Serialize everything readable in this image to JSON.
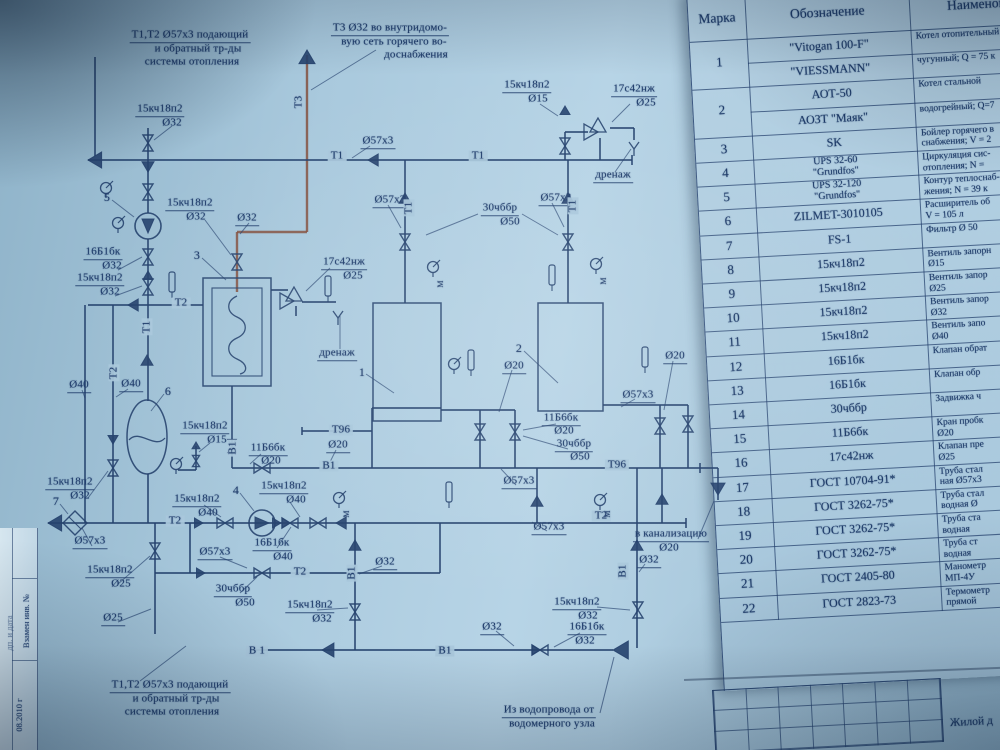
{
  "photo_meta": {
    "paper_color": "#a9c9dd",
    "line_color": "#27477a",
    "hot_pipe_color": "#84503e"
  },
  "frame": {
    "stamp_labels": [
      "Взамен инв. №",
      "08.2010 г",
      "дп. и дата"
    ]
  },
  "title_block": {
    "project_label": "Жилой д"
  },
  "diagram": {
    "labels": [
      "Т1,Т2 Ø57х3 подающий",
      "и обратный тр-ды",
      "системы отопления",
      "Т3 Ø32 во внутридомо-",
      "вую сеть горячего во-",
      "доснабжения",
      "15кч18п2",
      "Ø15",
      "17с42нж",
      "Ø25",
      "дренаж",
      "Т1",
      "Т1",
      "Ø57х3",
      "Т3",
      "15кч18п2",
      "Ø32",
      "5",
      "16Б1бк",
      "Ø32",
      "15кч18п2",
      "Ø32",
      "3",
      "15кч18п2",
      "Ø32",
      "Ø32",
      "17с42нж",
      "Ø25",
      "дренаж",
      "Т2",
      "Т1",
      "Т2",
      "Ø40",
      "Ø40",
      "6",
      "15кч18п2",
      "Ø15",
      "11Б6бк",
      "Ø20",
      "В1",
      "Т96",
      "Ø20",
      "В1",
      "15кч18п2",
      "Ø32",
      "7",
      "Ø57х3",
      "15кч18п2",
      "Ø25",
      "Т2",
      "15кч18п2",
      "Ø40",
      "4",
      "15кч18п2",
      "Ø40",
      "16Б1бк",
      "Ø40",
      "Ø57х3",
      "30чббр",
      "Ø50",
      "Т2",
      "Ø25",
      "Т1,Т2 Ø57х3 подающий",
      "и обратный тр-ды",
      "системы отопления",
      "15кч18п2",
      "Ø32",
      "В 1",
      "В1",
      "Ø32",
      "16Б1бк",
      "Ø32",
      "Из водопровода от",
      "водомерного узла",
      "Ø32",
      "В1",
      "15кч18п2",
      "Ø32",
      "Ø57х3",
      "Т1",
      "Ø57х3",
      "Т1",
      "30чббр",
      "Ø50",
      "1",
      "2",
      "Ø20",
      "11Б6бк",
      "Ø20",
      "30чббр",
      "Ø50",
      "Ø57х3",
      "Ø20",
      "Ø57х3",
      "Ø57х3",
      "Т96",
      "Т2",
      "в канализацию",
      "Ø20",
      "Ø32",
      "В1",
      "М",
      "М",
      "М",
      "М"
    ]
  },
  "table": {
    "headers": [
      "Марка",
      "Обозначение",
      "Наименование"
    ],
    "rows": [
      {
        "mark": "1",
        "des": "\"Vitogan 100-F\"",
        "n1": "Котел отопительный",
        "n2": "",
        "shift": true
      },
      {
        "mark": "",
        "des": "\"VIESSMANN\"",
        "n1": "чугунный; Q = 75 к",
        "n2": "",
        "cont": true
      },
      {
        "mark": "2",
        "des": "АОТ-50",
        "n1": "Котел стальной",
        "n2": "",
        "shift": true
      },
      {
        "mark": "",
        "des": "АОЗТ \"Маяк\"",
        "n1": "водогрейный; Q=7",
        "n2": "",
        "cont": true
      },
      {
        "mark": "3",
        "des": "SK",
        "n1": "Бойлер горячего в",
        "n2": "снабжения; V = 2"
      },
      {
        "mark": "4",
        "des": "UPS 32-60",
        "des2": "\"Grundfos\"",
        "n1": "Циркуляция сис-",
        "n2": "отопления; N ="
      },
      {
        "mark": "5",
        "des": "UPS 32-120",
        "des2": "\"Grundfos\"",
        "n1": "Контур теплоснаб-",
        "n2": "жения; N = 39 к"
      },
      {
        "mark": "6",
        "des": "ZILMET-3010105",
        "n1": "Расширитель об",
        "n2": "V = 105 л"
      },
      {
        "mark": "7",
        "des": "FS-1",
        "n1": "Фильтр Ø 50",
        "n2": ""
      },
      {
        "mark": "8",
        "des": "15кч18п2",
        "n1": "Вентиль запорн",
        "n2": "Ø15"
      },
      {
        "mark": "9",
        "des": "15кч18п2",
        "n1": "Вентиль запор",
        "n2": "Ø25"
      },
      {
        "mark": "10",
        "des": "15кч18п2",
        "n1": "Вентиль запор",
        "n2": "Ø32"
      },
      {
        "mark": "11",
        "des": "15кч18п2",
        "n1": "Вентиль запо",
        "n2": "Ø40"
      },
      {
        "mark": "12",
        "des": "16Б1бк",
        "n1": "Клапан обрат",
        "n2": ""
      },
      {
        "mark": "13",
        "des": "16Б1бк",
        "n1": "Клапан обр",
        "n2": ""
      },
      {
        "mark": "14",
        "des": "30чббр",
        "n1": "Задвижка ч",
        "n2": ""
      },
      {
        "mark": "15",
        "des": "11Б6бк",
        "n1": "Кран пробк",
        "n2": "Ø20"
      },
      {
        "mark": "16",
        "des": "17с42нж",
        "n1": "Клапан пре",
        "n2": "Ø25"
      },
      {
        "mark": "17",
        "des": "ГОСТ 10704-91*",
        "n1": "Труба стал",
        "n2": "ная Ø57х3"
      },
      {
        "mark": "18",
        "des": "ГОСТ 3262-75*",
        "n1": "Труба стал",
        "n2": "водная Ø"
      },
      {
        "mark": "19",
        "des": "ГОСТ 3262-75*",
        "n1": "Труба ста",
        "n2": "водная"
      },
      {
        "mark": "20",
        "des": "ГОСТ 3262-75*",
        "n1": "Труба ст",
        "n2": "водная"
      },
      {
        "mark": "21",
        "des": "ГОСТ 2405-80",
        "n1": "Манометр",
        "n2": "МП-4У"
      },
      {
        "mark": "22",
        "des": "ГОСТ 2823-73",
        "n1": "Термометр",
        "n2": "прямой"
      }
    ]
  }
}
